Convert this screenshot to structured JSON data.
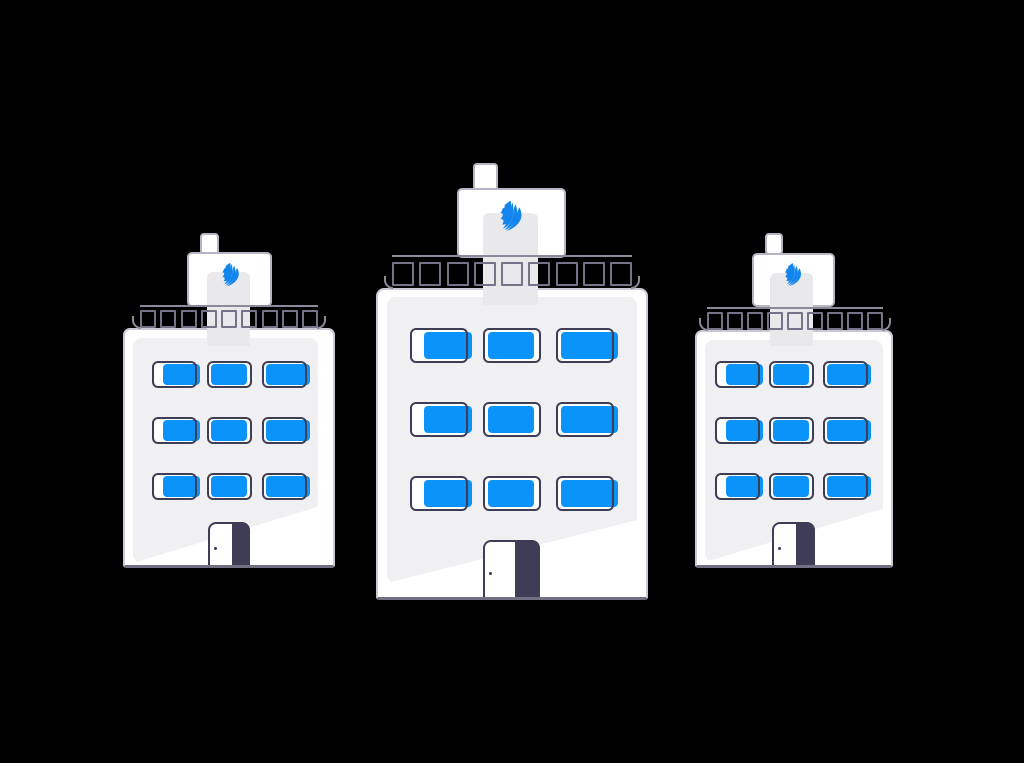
{
  "scene": {
    "type": "vector-illustration",
    "subject": "Three white office buildings with blue windows and branded rooftop signs on a black background",
    "background_color": "#000000"
  },
  "colors": {
    "background": "#000000",
    "building_fill": "#ffffff",
    "building_border": "#c9c8d4",
    "panel_fill": "#f0f0f2",
    "band_fill": "#e9e9ec",
    "window_frame": "#3f3d56",
    "window_glass": "#0a93f8",
    "logo_blue": "#1386ee",
    "door_dark": "#3f3d56",
    "baluster_border": "#757388",
    "rail_border": "#8b8a9a",
    "sign_border": "#b6b5c3",
    "chimney_border": "#b6b5c3",
    "ground_line": "#716f82"
  },
  "buildings": [
    {
      "id": "left",
      "size": "small",
      "floors": 3,
      "windows_per_floor": 3,
      "balusters": 9,
      "has_rooftop_sign": true,
      "has_chimney": true,
      "logo": "book-pages-logo",
      "door_style": "half-dark"
    },
    {
      "id": "center",
      "size": "large",
      "floors": 3,
      "windows_per_floor": 3,
      "balusters": 9,
      "has_rooftop_sign": true,
      "has_chimney": true,
      "logo": "book-pages-logo",
      "door_style": "half-dark"
    },
    {
      "id": "right",
      "size": "small",
      "floors": 3,
      "windows_per_floor": 3,
      "balusters": 9,
      "has_rooftop_sign": true,
      "has_chimney": true,
      "logo": "book-pages-logo",
      "door_style": "half-dark"
    }
  ]
}
